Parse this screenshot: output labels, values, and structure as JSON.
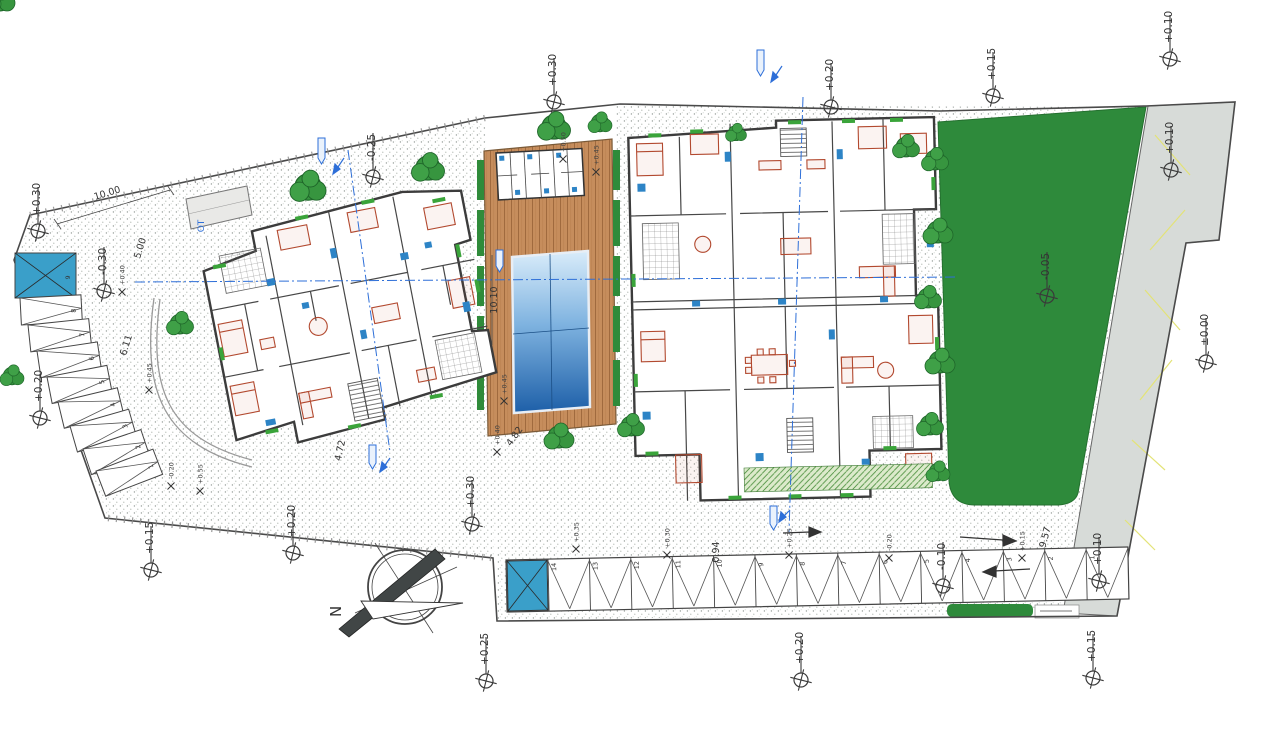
{
  "drawing": {
    "type": "architectural site plan",
    "compass": {
      "letter": "N"
    },
    "elevation_markers": [
      {
        "label": "+0.30",
        "x": 38,
        "y": 231
      },
      {
        "label": "+0.30",
        "x": 554,
        "y": 102
      },
      {
        "label": "+0.20",
        "x": 831,
        "y": 107
      },
      {
        "label": "+0.15",
        "x": 993,
        "y": 96
      },
      {
        "label": "+0.10",
        "x": 1170,
        "y": 59
      },
      {
        "label": "+0.10",
        "x": 1171,
        "y": 170
      },
      {
        "label": "±0.00",
        "x": 1206,
        "y": 362
      },
      {
        "label": "-0.05",
        "x": 1047,
        "y": 296
      },
      {
        "label": "-0.25",
        "x": 373,
        "y": 177
      },
      {
        "label": "-0.30",
        "x": 104,
        "y": 291
      },
      {
        "label": "+0.20",
        "x": 40,
        "y": 418
      },
      {
        "label": "+0.15",
        "x": 151,
        "y": 570
      },
      {
        "label": "+0.20",
        "x": 293,
        "y": 553
      },
      {
        "label": "+0.30",
        "x": 472,
        "y": 524
      },
      {
        "label": "+0.25",
        "x": 486,
        "y": 681
      },
      {
        "label": "+0.20",
        "x": 801,
        "y": 680
      },
      {
        "label": "-0.10",
        "x": 943,
        "y": 586
      },
      {
        "label": "+0.10",
        "x": 1099,
        "y": 581
      },
      {
        "label": "+0.15",
        "x": 1093,
        "y": 678
      }
    ],
    "spot_elevations": [
      {
        "label": "+0.50",
        "x": 563,
        "y": 150
      },
      {
        "label": "+0.45",
        "x": 596,
        "y": 163
      },
      {
        "label": "+0.45",
        "x": 504,
        "y": 392
      },
      {
        "label": "+0.40",
        "x": 122,
        "y": 283
      },
      {
        "label": "+0.45",
        "x": 149,
        "y": 381
      },
      {
        "label": "+0.55",
        "x": 200,
        "y": 482
      },
      {
        "label": "-0.20",
        "x": 171,
        "y": 477
      },
      {
        "label": "+0.40",
        "x": 497,
        "y": 443
      },
      {
        "label": "+0.35",
        "x": 576,
        "y": 540
      },
      {
        "label": "+0.30",
        "x": 667,
        "y": 546
      },
      {
        "label": "+0.25",
        "x": 789,
        "y": 546
      },
      {
        "label": "-0.20",
        "x": 889,
        "y": 549
      },
      {
        "label": "+0.15",
        "x": 1022,
        "y": 549
      }
    ],
    "dimensions": [
      {
        "label": "10.00",
        "x": 108,
        "y": 196,
        "rot": -17
      },
      {
        "label": "5.00",
        "x": 143,
        "y": 249,
        "rot": -73
      },
      {
        "label": "6.11",
        "x": 129,
        "y": 346,
        "rot": -73
      },
      {
        "label": "10.10",
        "x": 497,
        "y": 300,
        "rot": -90
      },
      {
        "label": "4.72",
        "x": 343,
        "y": 451,
        "rot": -78
      },
      {
        "label": "4.82",
        "x": 517,
        "y": 438,
        "rot": -55
      },
      {
        "label": "0.94",
        "x": 719,
        "y": 552,
        "rot": -90
      },
      {
        "label": "9.57",
        "x": 1048,
        "y": 538,
        "rot": -75
      }
    ],
    "annotations": [
      {
        "label": "OT",
        "x": 204,
        "y": 226,
        "rot": -90,
        "color": "#2e6fd8"
      }
    ],
    "parking": {
      "left_column_numbers": [
        "9",
        "8",
        "7",
        "6",
        "5",
        "4",
        "3",
        "2",
        "1"
      ],
      "bottom_row_numbers": [
        "14",
        "13",
        "12",
        "11",
        "10",
        "9",
        "8",
        "7",
        "6",
        "5",
        "4",
        "3",
        "2",
        "1"
      ],
      "accessible_color": "#3a9fc9"
    },
    "colors": {
      "lawn": "#2e8a3b",
      "road": "#d7dbd8",
      "road_marking": "#e3e377",
      "deck": "#c68d5c",
      "pool_deep": "#1d5fa8",
      "pool_shallow": "#d9ecfa",
      "furniture": "#b2492f",
      "fixtures": "#2d84c6",
      "axis_blue": "#2e6fd8",
      "wall": "#3c3c3c"
    }
  }
}
